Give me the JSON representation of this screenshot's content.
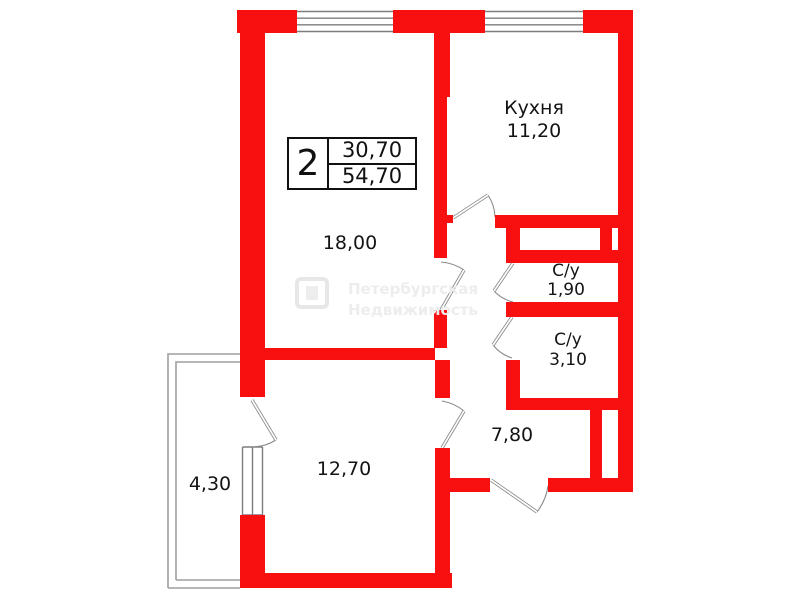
{
  "info_box": {
    "room_count": "2",
    "value_top": "30,70",
    "value_bottom": "54,70"
  },
  "labels": [
    {
      "id": "kitchen-name",
      "text": "Кухня",
      "x": 534,
      "y": 108,
      "fs": 19
    },
    {
      "id": "kitchen-area",
      "text": "11,20",
      "x": 534,
      "y": 131,
      "fs": 19
    },
    {
      "id": "living-room-area",
      "text": "18,00",
      "x": 350,
      "y": 243,
      "fs": 19
    },
    {
      "id": "bedroom-area",
      "text": "12,70",
      "x": 344,
      "y": 469,
      "fs": 19
    },
    {
      "id": "hall-area",
      "text": "7,80",
      "x": 512,
      "y": 435,
      "fs": 19
    },
    {
      "id": "balcony-area",
      "text": "4,30",
      "x": 210,
      "y": 484,
      "fs": 19
    },
    {
      "id": "wc1-name",
      "text": "С/у",
      "x": 566,
      "y": 271,
      "fs": 17
    },
    {
      "id": "wc1-area",
      "text": "1,90",
      "x": 566,
      "y": 290,
      "fs": 17
    },
    {
      "id": "wc2-name",
      "text": "С/у",
      "x": 568,
      "y": 340,
      "fs": 17
    },
    {
      "id": "wc2-area",
      "text": "3,10",
      "x": 568,
      "y": 360,
      "fs": 17
    }
  ],
  "watermark": {
    "line1": "Петербургская",
    "line2": "Недвижимость"
  },
  "colors": {
    "wall": "#f80f0f",
    "line": "#8a8a8a",
    "window": "#7d7d7d",
    "balcony": "#9e9e9e",
    "text": "#141414",
    "watermark": "#ebebeb"
  },
  "floorplan": {
    "walls": [
      [
        237,
        10,
        60,
        23
      ],
      [
        393,
        10,
        92,
        23
      ],
      [
        583,
        10,
        50,
        23
      ],
      [
        240,
        33,
        25,
        364
      ],
      [
        240,
        515,
        25,
        73
      ],
      [
        265,
        348,
        170,
        12
      ],
      [
        240,
        573,
        212,
        15
      ],
      [
        434,
        33,
        16,
        64
      ],
      [
        434,
        97,
        13,
        118
      ],
      [
        434,
        215,
        19,
        8
      ],
      [
        434,
        223,
        13,
        35
      ],
      [
        434,
        310,
        13,
        38
      ],
      [
        435,
        360,
        15,
        38
      ],
      [
        435,
        448,
        15,
        140
      ],
      [
        495,
        215,
        138,
        13
      ],
      [
        506,
        215,
        14,
        48
      ],
      [
        600,
        228,
        12,
        24
      ],
      [
        506,
        250,
        127,
        13
      ],
      [
        506,
        302,
        127,
        15
      ],
      [
        506,
        360,
        14,
        38
      ],
      [
        506,
        398,
        127,
        12
      ],
      [
        590,
        410,
        12,
        68
      ],
      [
        448,
        478,
        42,
        14
      ],
      [
        548,
        478,
        85,
        14
      ],
      [
        618,
        33,
        15,
        459
      ]
    ],
    "windows": [
      {
        "name": "window-living-room",
        "type": "h",
        "x1": 297,
        "x2": 393,
        "y": 10,
        "h": 23,
        "lines": 4
      },
      {
        "name": "window-kitchen",
        "type": "h",
        "x1": 485,
        "x2": 583,
        "y": 10,
        "h": 23,
        "lines": 4
      },
      {
        "name": "window-bedroom-balcony",
        "type": "v",
        "y1": 447,
        "y2": 515,
        "x": 240,
        "w": 25,
        "lines": 3
      }
    ],
    "doors": [
      {
        "name": "kitchen-door",
        "leaf": [
          453,
          218,
          488,
          195
        ],
        "arc": "M495 217 A43 43 0 0 0 488 195"
      },
      {
        "name": "living-room-door",
        "leaf": [
          441,
          310,
          464,
          270
        ],
        "arc": "M441 262 A48 48 0 0 1 464 270"
      },
      {
        "name": "bedroom-door",
        "leaf": [
          442,
          448,
          464,
          411
        ],
        "arc": "M442 401 A47 47 0 0 1 464 411"
      },
      {
        "name": "balcony-door",
        "leaf": [
          252,
          400,
          276,
          440
        ],
        "arc": "M276 440 A47 47 0 0 1 253 447"
      },
      {
        "name": "wc1-door",
        "leaf": [
          513,
          263,
          494,
          291
        ],
        "arc": "M494 291 A39 39 0 0 0 513 302"
      },
      {
        "name": "wc2-door",
        "leaf": [
          512,
          317,
          493,
          345
        ],
        "arc": "M493 345 A39 39 0 0 0 512 358"
      },
      {
        "name": "entrance-door",
        "leaf": [
          491,
          480,
          537,
          512
        ],
        "arc": "M537 512 A56 56 0 0 0 548 486"
      }
    ],
    "balcony": {
      "outer": "M168 588 L168 354 L240 354 M168 588 L240 588",
      "inner": "M176 580 L176 362 L240 362 M176 580 L240 580"
    }
  }
}
